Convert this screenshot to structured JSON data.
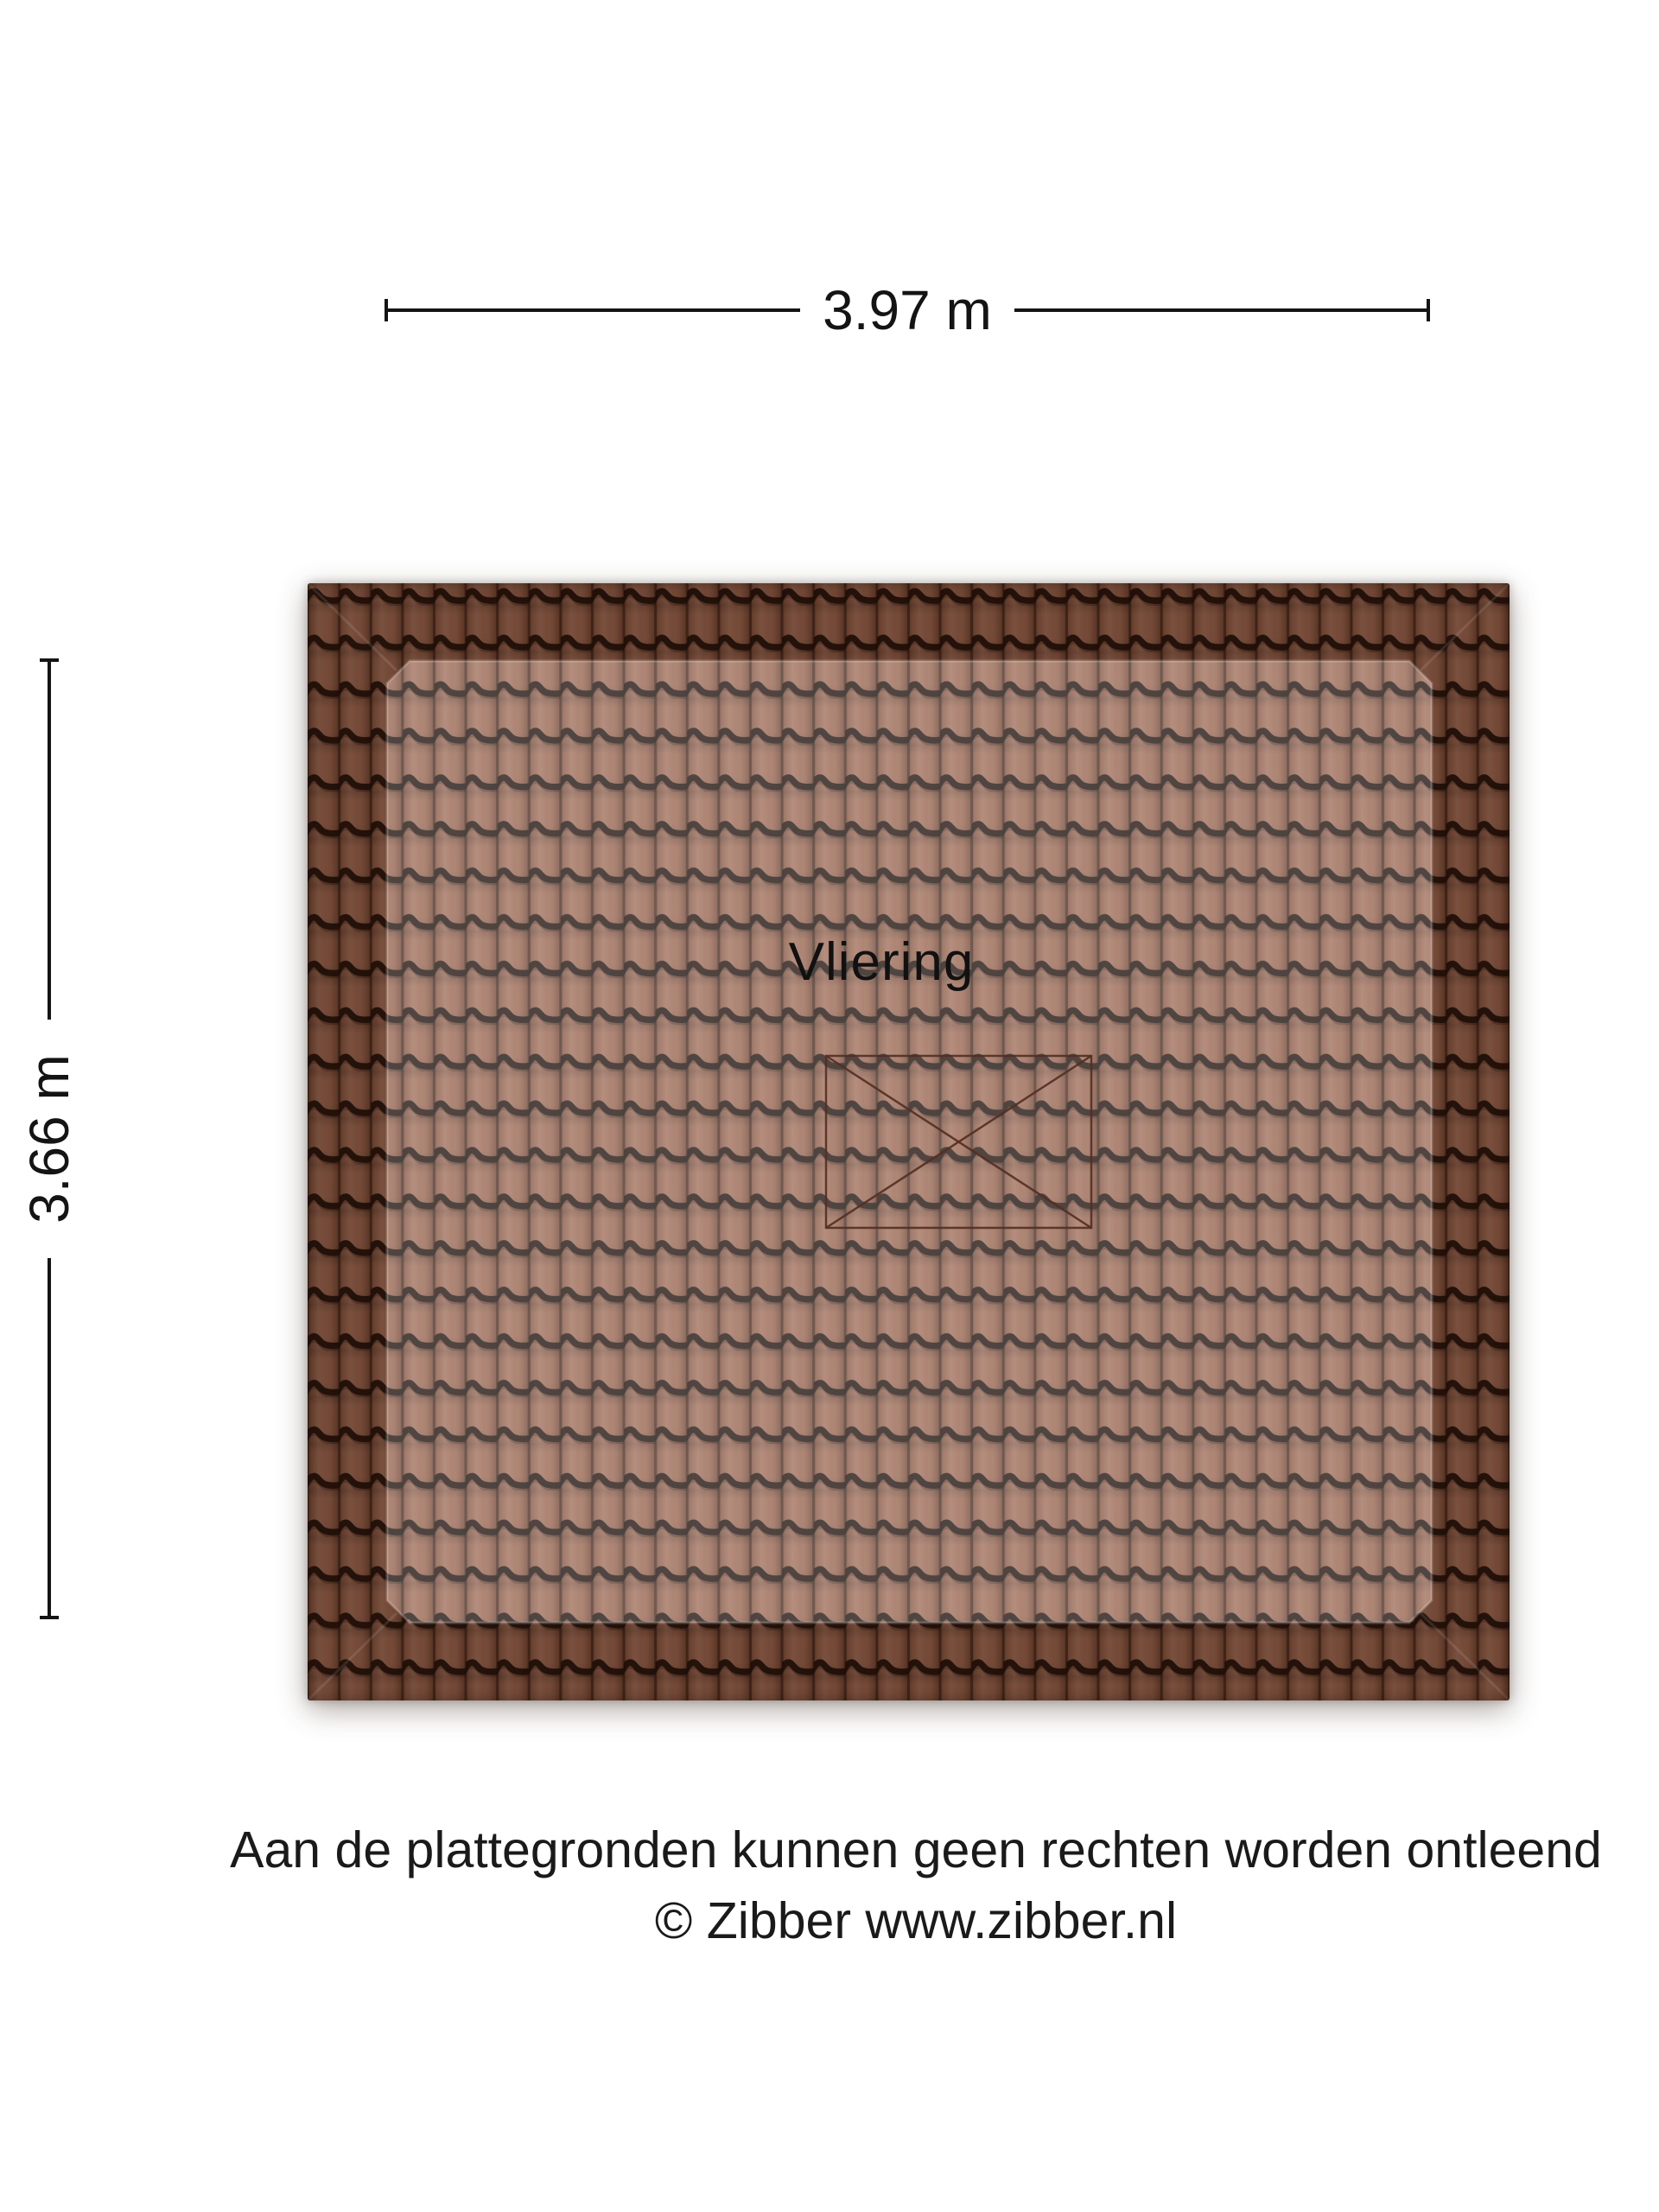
{
  "floorplan": {
    "room_label": "Vliering",
    "width_dimension": "3.97 m",
    "height_dimension": "3.66 m"
  },
  "footer": {
    "disclaimer": "Aan de plattegronden kunnen geen rechten worden ontleend",
    "copyright": "© Zibber www.zibber.nl"
  },
  "colors": {
    "background": "#ffffff",
    "tile_base": "#96604a",
    "tile_groove": "#170b06",
    "roof_border_shade": "#2e1608",
    "room_overlay": "#ffffff",
    "hatch_line": "#532d21",
    "dimension_line": "#141414",
    "text": "#1a1a1a"
  }
}
